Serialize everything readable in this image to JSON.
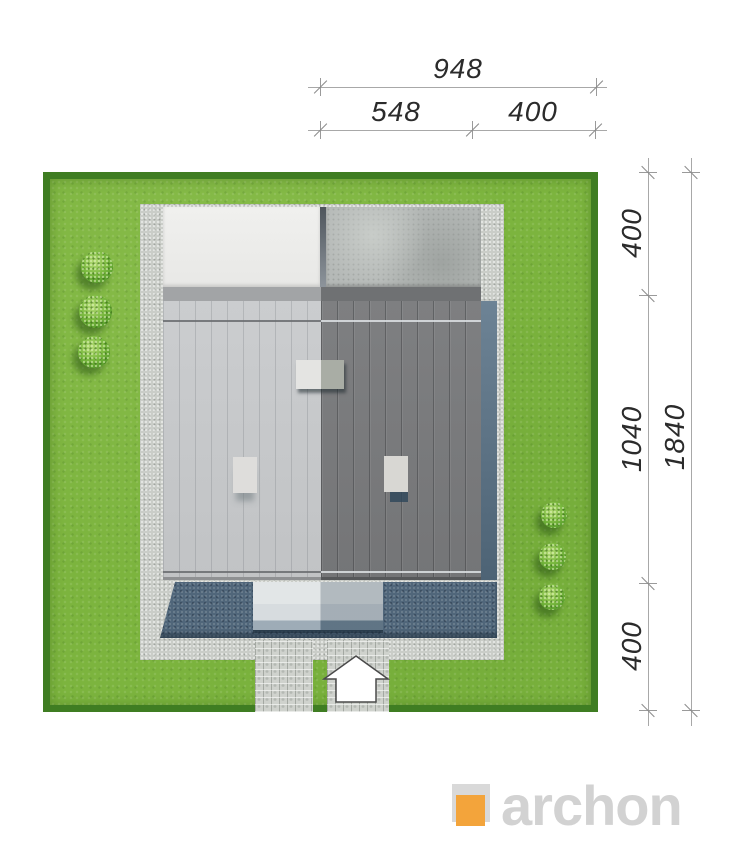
{
  "dimensions": {
    "top": {
      "overall": "948",
      "segment_left": "548",
      "segment_right": "400"
    },
    "right": {
      "segment_top": "400",
      "segment_middle": "1040",
      "segment_bottom": "400",
      "overall": "1840"
    }
  },
  "logo": {
    "text": "archon",
    "text_color": "#d2d2d2",
    "accent_color": "#f3a43b"
  },
  "colors": {
    "grass": "#7cb43e",
    "hedge_border": "#3f7d22",
    "paving_light_gray": "#cacdc8",
    "terrace_white": "#efefed",
    "terrace_concrete": "#b5b9b7",
    "roof_light_half": "#c7c9cb",
    "roof_dark_half": "#7a7b7d",
    "slate_paving": "#50667a",
    "dimension_line": "#a8a8a8",
    "dimension_text": "#2b2b2b"
  },
  "icons": {
    "entrance-arrow-icon": "white house-shaped arrow pointing up",
    "bush-icon": "round green shrub, top view",
    "logo-mark-icon": "gray square overlapped by orange square"
  }
}
